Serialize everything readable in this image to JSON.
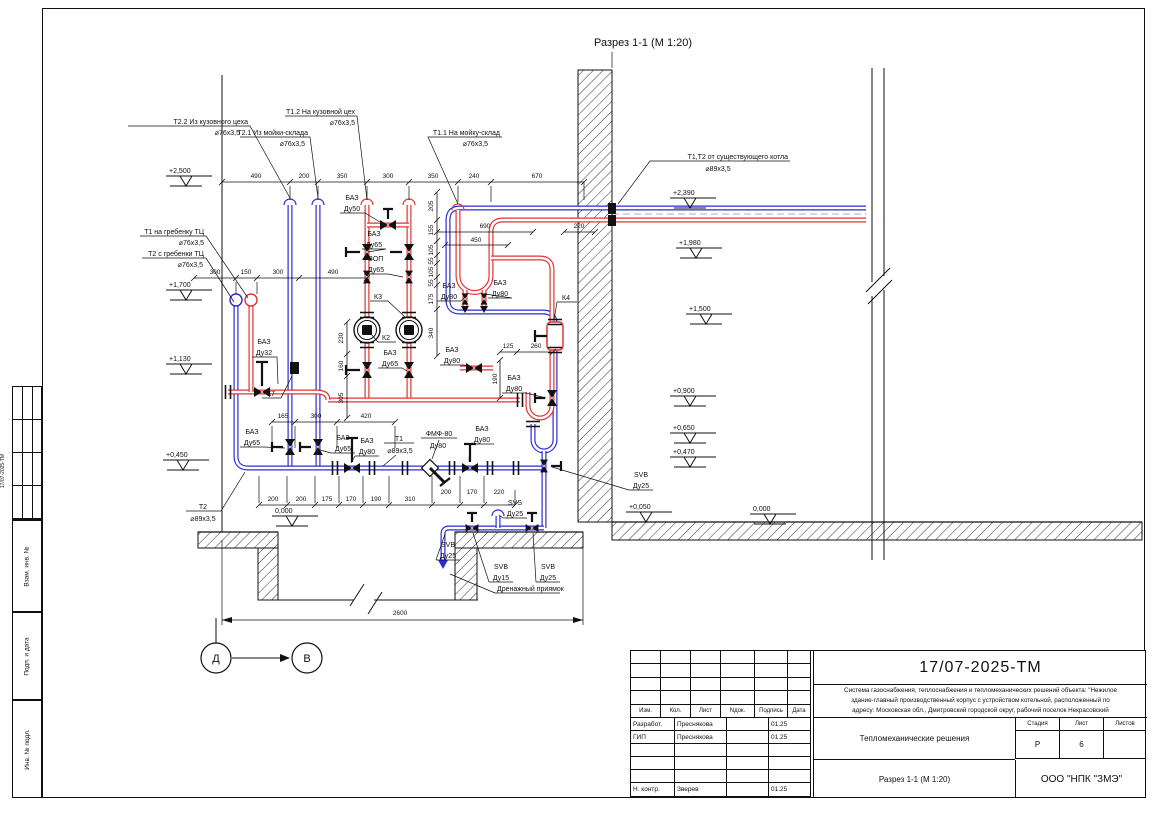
{
  "page": {
    "section_title": "Разрез 1-1 (М 1:20)"
  },
  "markers": {
    "left": "Д",
    "right": "В"
  },
  "sidebar": {
    "vertical_doc_no": "17/07-2025-ТМ",
    "boxes": [
      "Взам. инв. №",
      "Подп. и дата",
      "Инв. № подл."
    ]
  },
  "title_block": {
    "doc_number": "17/07-2025-ТМ",
    "description_lines": [
      "Система газоснабжения, теплоснабжения и тепломеханических решений объекта: \"Нежилое",
      "здание-главный производственный корпус с устройством котельной, расположенный по",
      "адресу: Московская обл., Дмитровский городской округ, рабочий поселок Некрасовский"
    ],
    "header_cols": [
      "Изм.",
      "Кол.",
      "Лист",
      "Nдок.",
      "Подпись",
      "Дата"
    ],
    "rows": [
      {
        "role": "Разработ.",
        "name": "Преснякова",
        "sign": "",
        "date": "01.25"
      },
      {
        "role": "ГИП",
        "name": "Преснякова",
        "sign": "",
        "date": "01.25"
      },
      {
        "role": "",
        "name": "",
        "sign": "",
        "date": ""
      },
      {
        "role": "",
        "name": "",
        "sign": "",
        "date": ""
      },
      {
        "role": "",
        "name": "",
        "sign": "",
        "date": ""
      },
      {
        "role": "Н. контр.",
        "name": "Зверев",
        "sign": "",
        "date": "01.25"
      }
    ],
    "project_name": "Тепломеханические решения",
    "stage_cols": [
      "Стадия",
      "Лист",
      "Листов"
    ],
    "stage_vals": [
      "Р",
      "6",
      ""
    ],
    "view_name": "Разрез 1-1 (М 1:20)",
    "company": "ООО \"НПК \"ЗМЭ\""
  },
  "drawing": {
    "leaders": [
      {
        "l1": "Т2.2 Из кузовного цеха",
        "l2": "⌀76х3,5"
      },
      {
        "l1": "Т2.1 Из мойки-склада",
        "l2": "⌀76х3,5"
      },
      {
        "l1": "Т1.2 На кузовной цех",
        "l2": "⌀76х3,5"
      },
      {
        "l1": "Т1.1 На мойку-склад",
        "l2": "⌀76х3,5"
      },
      {
        "l1": "Т1,Т2 от существующего котла",
        "l2": "⌀89х3,5"
      },
      {
        "l1": "Т1 на гребенку ТЦ",
        "l2": "⌀76х3,5"
      },
      {
        "l1": "Т2 с гребенки ТЦ",
        "l2": "⌀76х3,5"
      },
      {
        "l1": "Т2",
        "l2": "⌀89х3,5"
      },
      {
        "l1": "Т1",
        "l2": "⌀89х3,5"
      },
      {
        "l1": "ФМФ-80",
        "l2": "Ду80"
      },
      {
        "l1": "Дренажный приямок",
        "l2": ""
      }
    ],
    "equipment": [
      {
        "l1": "БАЗ",
        "l2": "Ду50"
      },
      {
        "l1": "БАЗ",
        "l2": "Ду65"
      },
      {
        "l1": "ЗОП",
        "l2": "Ду65"
      },
      {
        "l1": "БАЗ",
        "l2": "Ду32"
      },
      {
        "l1": "К7",
        "l2": ""
      },
      {
        "l1": "К3",
        "l2": ""
      },
      {
        "l1": "К2",
        "l2": ""
      },
      {
        "l1": "БАЗ",
        "l2": "Ду80"
      },
      {
        "l1": "БАЗ",
        "l2": "Ду80"
      },
      {
        "l1": "БАЗ",
        "l2": "Ду65"
      },
      {
        "l1": "БАЗ",
        "l2": "Ду80"
      },
      {
        "l1": "БАЗ",
        "l2": "Ду80"
      },
      {
        "l1": "БАЗ",
        "l2": "Ду65"
      },
      {
        "l1": "БАЗ",
        "l2": "Ду65"
      },
      {
        "l1": "БАЗ",
        "l2": "Ду80"
      },
      {
        "l1": "БАЗ",
        "l2": "Ду80"
      },
      {
        "l1": "SVB",
        "l2": "Ду25"
      },
      {
        "l1": "SVS",
        "l2": "Ду25"
      },
      {
        "l1": "SVB",
        "l2": "Ду25"
      },
      {
        "l1": "SVB",
        "l2": "Ду15"
      },
      {
        "l1": "SVB",
        "l2": "Ду25"
      },
      {
        "l1": "К4",
        "l2": ""
      }
    ],
    "elev_left": [
      "+2,500",
      "+1,700",
      "+1,130",
      "+0,450",
      "0,000"
    ],
    "elev_right": [
      "+2,390",
      "+1,980",
      "+1,500",
      "+0,900",
      "+0,650",
      "+0,470",
      "+0,050",
      "0,000"
    ],
    "dims": {
      "top": [
        "490",
        "200",
        "350",
        "300",
        "350",
        "240",
        "670"
      ],
      "left": [
        "300",
        "150",
        "300",
        "490"
      ],
      "right_top": [
        "690",
        "450",
        "220"
      ],
      "vmain": [
        "205",
        "155",
        "105",
        "55",
        "105",
        "55",
        "175",
        "340"
      ],
      "vleft": [
        "230",
        "160",
        "305"
      ],
      "small": [
        "125",
        "260",
        "190"
      ],
      "mid": [
        "165",
        "300",
        "420"
      ],
      "bottom": [
        "200",
        "200",
        "175",
        "170",
        "190",
        "310",
        "200",
        "170",
        "220"
      ],
      "overall": "2600"
    }
  }
}
